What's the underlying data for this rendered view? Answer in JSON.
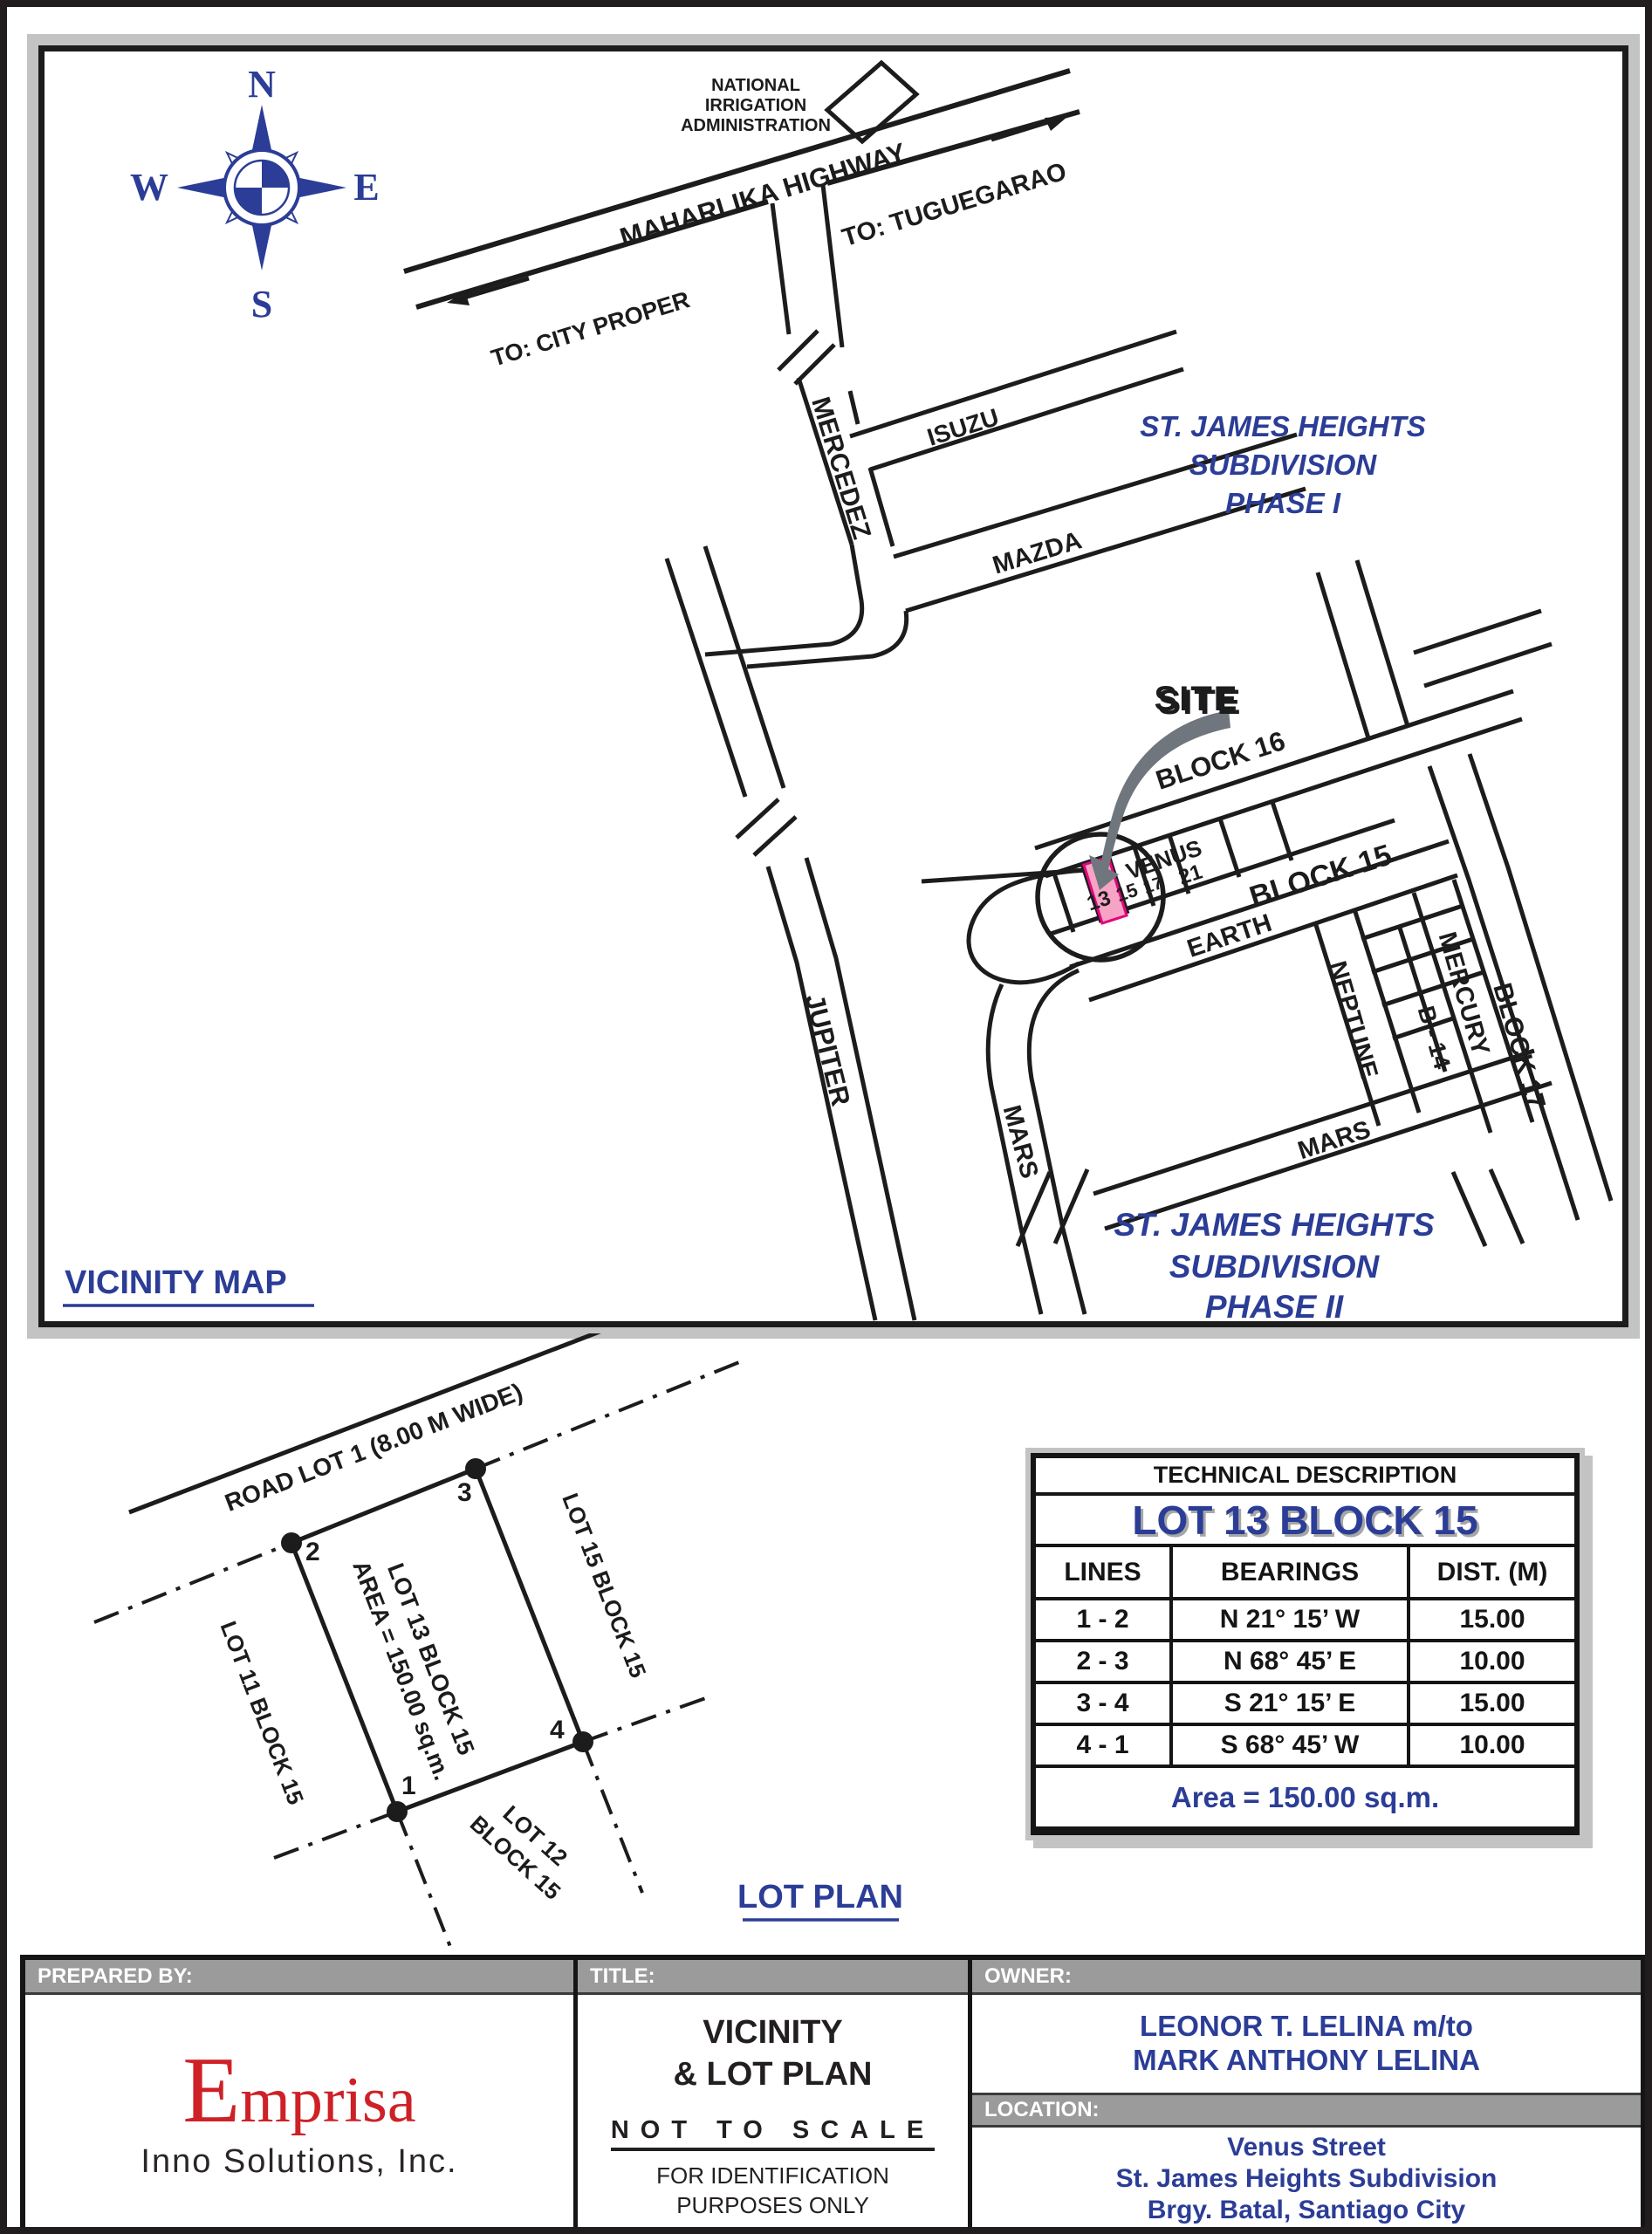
{
  "colors": {
    "blue": "#2b3d96",
    "site_red": "#e8262c",
    "logo_red": "#ce2127",
    "pink_lot": "#f7a3c5",
    "bar_gray": "#9b9b9b",
    "shadow_gray": "#c3c3c3"
  },
  "vicinity_map": {
    "title": "VICINITY MAP",
    "compass": {
      "n": "N",
      "s": "S",
      "e": "E",
      "w": "W"
    },
    "nia_line1": "NATIONAL",
    "nia_line2": "IRRIGATION",
    "nia_line3": "ADMINISTRATION",
    "highway": {
      "name": "MAHARLIKA HIGHWAY",
      "to_city": "TO: CITY PROPER",
      "to_tuguegarao": "TO: TUGUEGARAO"
    },
    "streets": {
      "mercedez": "MERCEDEZ",
      "isuzu": "ISUZU",
      "mazda": "MAZDA",
      "jupiter": "JUPITER",
      "mars_west": "MARS",
      "venus": "VENUS",
      "earth": "EARTH",
      "neptune": "NEPTUNE",
      "mercury": "MERCURY",
      "mars_south": "MARS"
    },
    "blocks": {
      "block16": "BLOCK 16",
      "block15": "BLOCK 15",
      "block17": "BLOCK 17",
      "b14": "B - 14"
    },
    "lot_numbers": {
      "l13": "13",
      "l15": "15",
      "l17": "17",
      "l21": "21"
    },
    "site": "SITE",
    "phase1": {
      "line1": "ST. JAMES HEIGHTS",
      "line2": "SUBDIVISION",
      "line3": "PHASE I"
    },
    "phase2": {
      "line1": "ST. JAMES HEIGHTS",
      "line2": "SUBDIVISION",
      "line3": "PHASE II"
    }
  },
  "lot_plan": {
    "title": "LOT PLAN",
    "road": "ROAD LOT 1 (8.00 M WIDE)",
    "subject_line1": "LOT 13 BLOCK 15",
    "subject_line2": "AREA = 150.00 sq.m.",
    "lot15": "LOT 15 BLOCK 15",
    "lot11": "LOT 11 BLOCK 15",
    "lot12_line1": "LOT 12",
    "lot12_line2": "BLOCK 15",
    "corners": [
      "1",
      "2",
      "3",
      "4"
    ]
  },
  "technical_description": {
    "title": "TECHNICAL DESCRIPTION",
    "subtitle": "LOT 13 BLOCK 15",
    "columns": [
      "LINES",
      "BEARINGS",
      "DIST. (M)"
    ],
    "rows": [
      {
        "lines": "1 - 2",
        "bearing": "N 21°  15’ W",
        "dist": "15.00"
      },
      {
        "lines": "2 - 3",
        "bearing": "N 68°  45’ E",
        "dist": "10.00"
      },
      {
        "lines": "3 - 4",
        "bearing": "S 21°  15’ E",
        "dist": "15.00"
      },
      {
        "lines": "4 - 1",
        "bearing": "S 68°  45’ W",
        "dist": "10.00"
      }
    ],
    "area": "Area = 150.00 sq.m."
  },
  "footer": {
    "prepared_by_label": "PREPARED BY:",
    "logo_initial": "E",
    "logo_rest": "mprisa",
    "logo_sub": "Inno Solutions, Inc.",
    "title_label": "TITLE:",
    "title_line1": "VICINITY",
    "title_line2": "& LOT PLAN",
    "scale_note": "NOT TO SCALE",
    "purpose_line1": "FOR IDENTIFICATION",
    "purpose_line2": "PURPOSES ONLY",
    "owner_label": "OWNER:",
    "owner_line1": "LEONOR T. LELINA m/to",
    "owner_line2": "MARK ANTHONY LELINA",
    "location_label": "LOCATION:",
    "location_line1": "Venus Street",
    "location_line2": "St. James Heights Subdivision",
    "location_line3": "Brgy. Batal, Santiago City"
  }
}
